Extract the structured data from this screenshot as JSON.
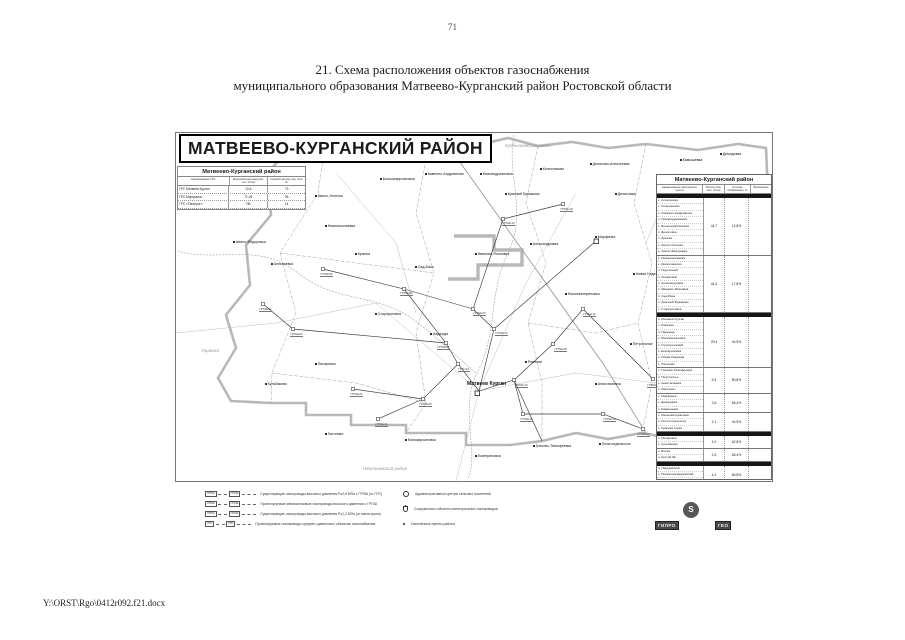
{
  "page": {
    "number": "71",
    "title_line1": "21. Схема расположения объектов газоснабжения",
    "title_line2": "муниципального образования Матвеево-Курганский район Ростовской области",
    "footer_path": "Y:\\ORST\\Rgo\\0412r092.f21.docx"
  },
  "map": {
    "title": "МАТВЕЕВО-КУРГАНСКИЙ РАЙОН",
    "areas": [
      {
        "x": 330,
        "y": 11,
        "t": "Куйбышевский район"
      },
      {
        "x": 26,
        "y": 216,
        "t": "Украина"
      },
      {
        "x": 188,
        "y": 334,
        "t": "Неклиновский район"
      }
    ],
    "labels": [
      {
        "x": 140,
        "y": 62,
        "t": "Авило-Успенка"
      },
      {
        "x": 58,
        "y": 108,
        "t": "Авило-Фёдоровка"
      },
      {
        "x": 150,
        "y": 92,
        "t": "Новониколаевка"
      },
      {
        "x": 96,
        "y": 130,
        "t": "Алексеевка"
      },
      {
        "x": 205,
        "y": 45,
        "t": "Большекирсановка"
      },
      {
        "x": 250,
        "y": 40,
        "t": "Каменно-Андрианово"
      },
      {
        "x": 305,
        "y": 40,
        "t": "Новоандриановка"
      },
      {
        "x": 365,
        "y": 35,
        "t": "Колесниково"
      },
      {
        "x": 415,
        "y": 30,
        "t": "Денисово-Алексеевка"
      },
      {
        "x": 505,
        "y": 26,
        "t": "Камышевка"
      },
      {
        "x": 545,
        "y": 20,
        "t": "Демидовка"
      },
      {
        "x": 180,
        "y": 120,
        "t": "Крынка"
      },
      {
        "x": 240,
        "y": 133,
        "t": "Сад-База"
      },
      {
        "x": 300,
        "y": 120,
        "t": "Иваново-Ясиновка"
      },
      {
        "x": 355,
        "y": 110,
        "t": "Александровка"
      },
      {
        "x": 420,
        "y": 103,
        "t": "Марфинка"
      },
      {
        "x": 458,
        "y": 140,
        "t": "Новая Надежда"
      },
      {
        "x": 200,
        "y": 180,
        "t": "Староротовка"
      },
      {
        "x": 255,
        "y": 200,
        "t": "Надежда"
      },
      {
        "x": 350,
        "y": 228,
        "t": "Ряженое"
      },
      {
        "x": 420,
        "y": 250,
        "t": "Анастасиевка"
      },
      {
        "x": 455,
        "y": 210,
        "t": "Петрополье"
      },
      {
        "x": 150,
        "y": 300,
        "t": "Латоново"
      },
      {
        "x": 230,
        "y": 306,
        "t": "Малокирсановка"
      },
      {
        "x": 300,
        "y": 322,
        "t": "Екатериновка"
      },
      {
        "x": 358,
        "y": 312,
        "t": "Греково-Тимофеевка"
      },
      {
        "x": 424,
        "y": 310,
        "t": "Политотдельское"
      },
      {
        "x": 90,
        "y": 250,
        "t": "Кульбаково"
      },
      {
        "x": 140,
        "y": 230,
        "t": "Писаревка"
      },
      {
        "x": 390,
        "y": 160,
        "t": "Малоекатериновка"
      },
      {
        "x": 330,
        "y": 60,
        "t": "Красный Бумажник"
      },
      {
        "x": 440,
        "y": 60,
        "t": "Денисовка"
      }
    ],
    "city": {
      "x": 292,
      "y": 250,
      "t": "Матвеев Курган"
    },
    "callouts": [
      {
        "x": 262,
        "y": 214,
        "t": "ГРПШ-07"
      },
      {
        "x": 320,
        "y": 200,
        "t": "ГРПШ-13"
      },
      {
        "x": 283,
        "y": 236,
        "t": "ГРП №1"
      },
      {
        "x": 340,
        "y": 252,
        "t": "ГРПШ-10"
      },
      {
        "x": 225,
        "y": 160,
        "t": "ГРПШ-05"
      },
      {
        "x": 379,
        "y": 216,
        "t": "ГРПШ-08"
      },
      {
        "x": 298,
        "y": 180,
        "t": "ГРПШ-03"
      },
      {
        "x": 408,
        "y": 181,
        "t": "ГРПШ-12"
      },
      {
        "x": 345,
        "y": 286,
        "t": "ГРПШ-16"
      },
      {
        "x": 428,
        "y": 286,
        "t": "ГРПШ-19"
      },
      {
        "x": 175,
        "y": 261,
        "t": "ГРПШ-21"
      },
      {
        "x": 115,
        "y": 201,
        "t": "ГРПШ-04"
      },
      {
        "x": 84,
        "y": 176,
        "t": "ГРПШ-02"
      },
      {
        "x": 145,
        "y": 141,
        "t": "ГРПШ-06"
      },
      {
        "x": 472,
        "y": 252,
        "t": "ГРПШ-14"
      },
      {
        "x": 462,
        "y": 301,
        "t": "ГРПШ-17"
      },
      {
        "x": 244,
        "y": 271,
        "t": "ГРПШ-09"
      },
      {
        "x": 200,
        "y": 291,
        "t": "ГРПШ-11"
      },
      {
        "x": 327,
        "y": 90,
        "t": "ГРПШ-15"
      },
      {
        "x": 385,
        "y": 76,
        "t": "ГРПШ-18"
      }
    ]
  },
  "left_table": {
    "title": "Матвеево-Курганский район",
    "headers": [
      "Наименование ГРС",
      "Максимальная нагрузка, тыс. м³/час",
      "Годовой расход газа, млн. м³"
    ],
    "rows": [
      [
        "ГРС Матвеев Курган",
        "10,6",
        "73"
      ],
      [
        "ГРС Марфинка",
        "71,45",
        "96"
      ],
      [
        "ГРС «Таганрог»",
        "ПВ",
        "14"
      ]
    ]
  },
  "right_table": {
    "title": "Матвеево-Курганский район",
    "headers": [
      "Наименование населенного пункта",
      "Расход газа, млн. м³/год",
      "Степень газификации, %",
      "Примечание"
    ],
    "sections": [
      {
        "band": true
      },
      {
        "names": [
          "с. Алексеевка",
          "х. Колесниково",
          "с. Каменно-Андрианово",
          "х. Новоандриановка",
          "с. Большекирсановка",
          "х. Денисовка",
          "п. Крынка",
          "с. Авило-Успенка",
          "х. Авило-Фёдоровка"
        ],
        "v1": "44,7",
        "v2": "12,8%"
      },
      {
        "names": [
          "с. Новониколаевка",
          "х. Шапошниково",
          "п. Подлесный",
          "п. Ленинский",
          "с. Александровка",
          "х. Иваново-Ясиновка",
          "п. Сад-База",
          "х. Красный Бумажник",
          "х. Староротовка"
        ],
        "v1": "44,2",
        "v2": "17,8%"
      },
      {
        "band": true
      },
      {
        "names": [
          "п. Матвеев Курган",
          "с. Ряженое",
          "п. Надежда",
          "с. Малокирсановка",
          "х. Сухореченский",
          "с. Екатериновка",
          "х. Новая Надежда",
          "с. Латоново"
        ],
        "v1": "29,4",
        "v2": "44,9%"
      },
      {
        "names": [
          "с. Греково-Тимофеевка",
          "х. Петрополье",
          "с. Анастасиевка",
          "х. Марченко"
        ],
        "v1": "9,4",
        "v2": "80,8%"
      },
      {
        "names": [
          "с. Марфинка",
          "х. Демидовка",
          "х. Камышевка"
        ],
        "v1": "2,6",
        "v2": "65,4%"
      },
      {
        "names": [
          "х. Малоекатериновка",
          "с. Политотдельское",
          "х. Красная Горка"
        ],
        "v1": "2,1",
        "v2": "44,9%"
      },
      {
        "band": true
      },
      {
        "names": [
          "х. Писаревка",
          "с. Кульбаково"
        ],
        "v1": "4,0",
        "v2": "62,8%"
      },
      {
        "names": [
          "х. Балка",
          "п. Крутой Яр"
        ],
        "v1": "2,6",
        "v2": "65,4%"
      },
      {
        "band": true
      },
      {
        "names": [
          "п. Гвардейский",
          "х. Новоалександровский",
          "х. Денисово-Николаевка"
        ],
        "v1": "4,1",
        "v2": "80,8%"
      },
      {
        "names": [
          "х. Степановка",
          "х. Ивановка"
        ],
        "v1": "1",
        "v2": "89,8%"
      }
    ]
  },
  "legend": {
    "left": [
      {
        "tag1": "ГРПШ",
        "tag2": "ГРПШ",
        "text": "Существующие газопроводы высокого давления Р≤0,6 МПа с ГРПШ (от ГРС)"
      },
      {
        "tag1": "ГРПШ",
        "tag2": "ГРПШ",
        "text": "Проектируемые межпоселковые газопроводы высокого давления с ГРПШ"
      },
      {
        "tag1": "ГРПШ",
        "tag2": "ГРПШ",
        "text": "Существующие газопроводы высокого давления Р≤1,2 МПа (от магистрали)"
      },
      {
        "tag1": "ГРП",
        "tag2": "ГРП",
        "text": "Проектируемые газопроводы среднего давления к объектам газоснабжения"
      }
    ],
    "right": [
      {
        "sym": "circle",
        "text": "Административные центры сельских поселений"
      },
      {
        "sym": "flask",
        "text": "Сооружения и объекты магистральных газопроводов"
      },
      {
        "sym": "dot",
        "text": "Населённые пункты района"
      }
    ]
  },
  "logo": {
    "emblem": "Ѕ",
    "text_left": "ГИПРО",
    "text_right": "ГЕО"
  }
}
